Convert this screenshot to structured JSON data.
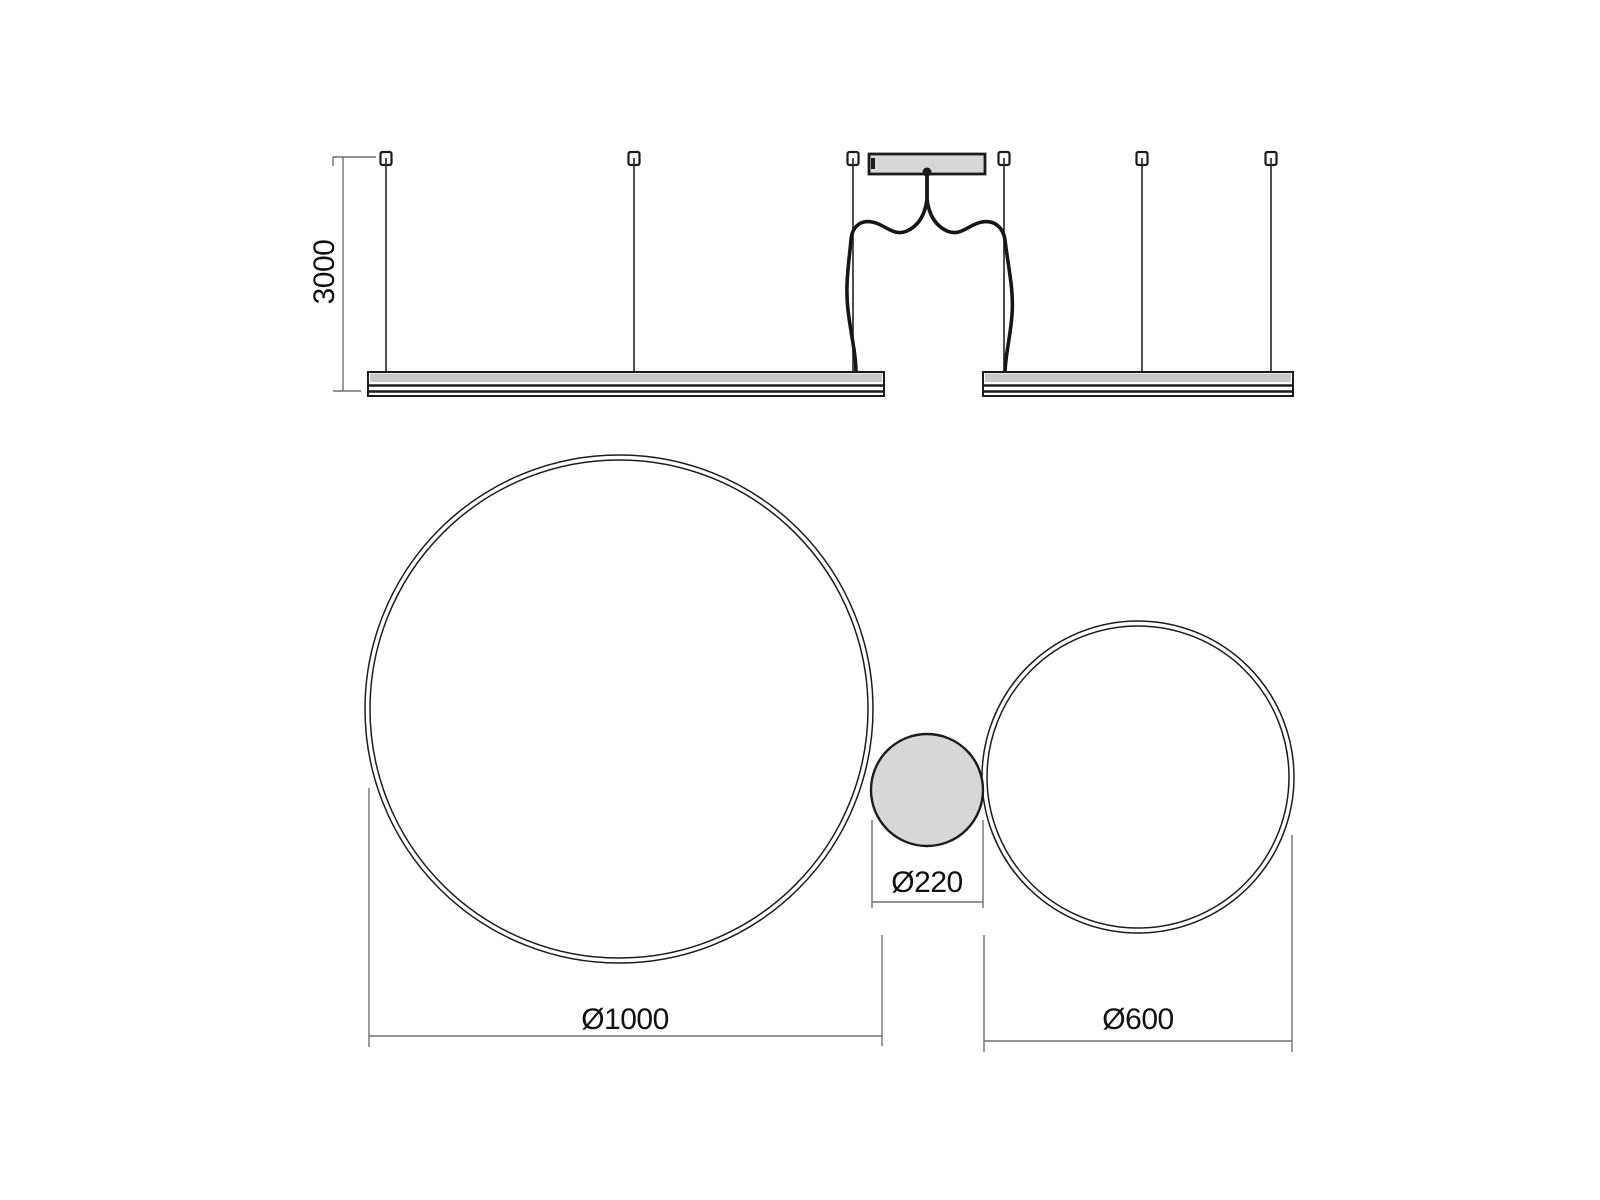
{
  "labels": {
    "suspension_height": "3000",
    "large_ring_diameter": "Ø1000",
    "driver_diameter": "Ø220",
    "small_ring_diameter": "Ø600"
  },
  "colors": {
    "background": "#ffffff",
    "line_dark": "#1c1c1c",
    "dimension_gray": "#6f6f6f",
    "fill_light_gray": "#d7d7d7",
    "bar_band_gray": "#c9c9c9"
  }
}
